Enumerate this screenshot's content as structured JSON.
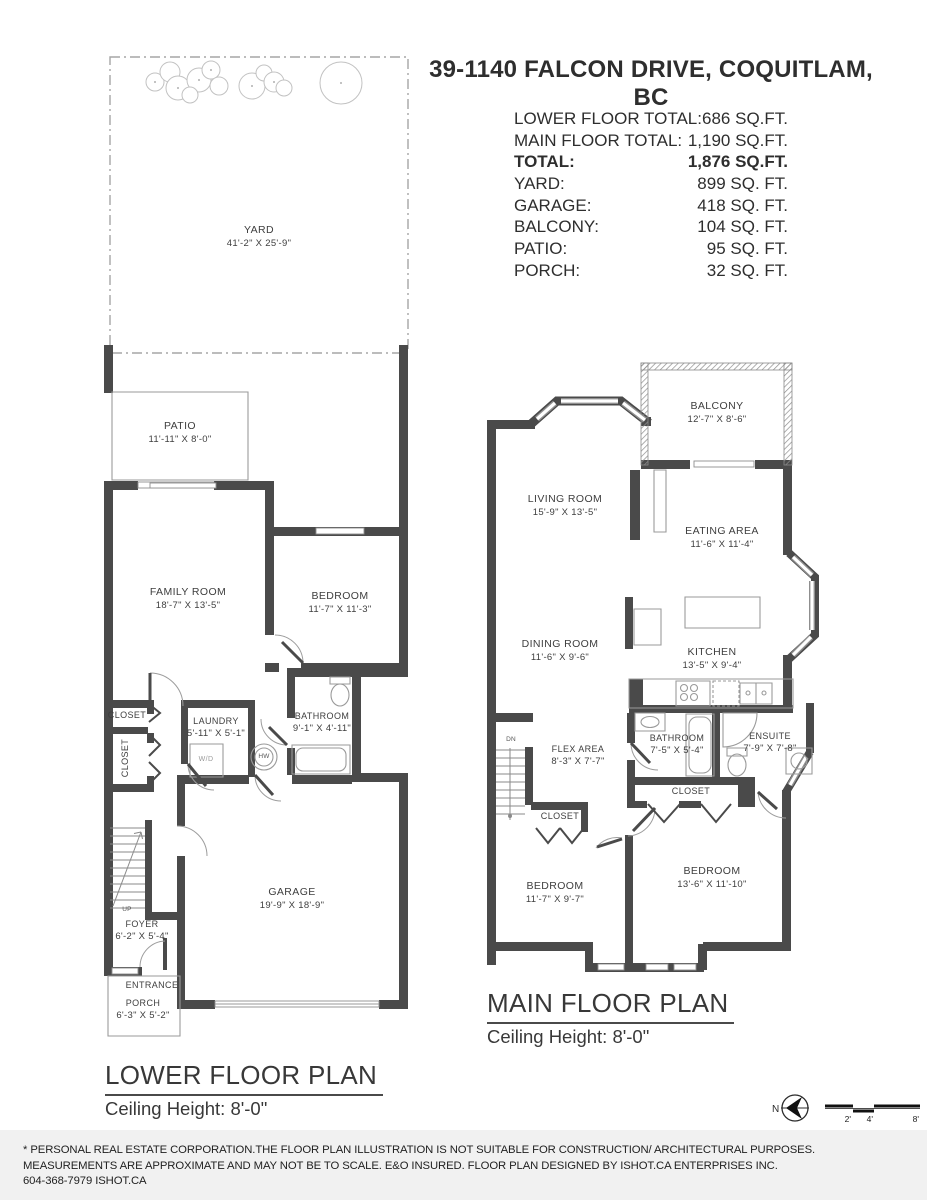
{
  "header": {
    "title": "39-1140 FALCON DRIVE, COQUITLAM, BC",
    "stats": [
      {
        "label": "LOWER FLOOR TOTAL:",
        "value": "686 SQ.FT."
      },
      {
        "label": "MAIN FLOOR TOTAL:",
        "value": "1,190 SQ.FT."
      },
      {
        "label": "TOTAL:",
        "value": "1,876 SQ.FT."
      },
      {
        "label": "YARD:",
        "value": "899 SQ. FT."
      },
      {
        "label": "GARAGE:",
        "value": "418 SQ. FT."
      },
      {
        "label": "BALCONY:",
        "value": "104 SQ. FT."
      },
      {
        "label": "PATIO:",
        "value": "95 SQ. FT."
      },
      {
        "label": "PORCH:",
        "value": "32 SQ. FT."
      }
    ]
  },
  "lower_plan": {
    "title": "LOWER FLOOR PLAN",
    "ceiling": "Ceiling Height: 8'-0\"",
    "rooms": [
      {
        "name": "YARD",
        "dims": "41'-2\" X 25'-9\""
      },
      {
        "name": "PATIO",
        "dims": "11'-11\" X 8'-0\""
      },
      {
        "name": "FAMILY ROOM",
        "dims": "18'-7\" X 13'-5\""
      },
      {
        "name": "BEDROOM",
        "dims": "11'-7\" X 11'-3\""
      },
      {
        "name": "CLOSET",
        "dims": ""
      },
      {
        "name": "CLOSET",
        "dims": ""
      },
      {
        "name": "LAUNDRY",
        "dims": "5'-11\" X 5'-1\""
      },
      {
        "name": "BATHROOM",
        "dims": "9'-1\" X 4'-11\""
      },
      {
        "name": "GARAGE",
        "dims": "19'-9\" X 18'-9\""
      },
      {
        "name": "FOYER",
        "dims": "6'-2\" X 5'-4\""
      },
      {
        "name": "ENTRANCE",
        "dims": ""
      },
      {
        "name": "PORCH",
        "dims": "6'-3\" X 5'-2\""
      }
    ],
    "markers": {
      "up": "UP",
      "wd": "W/D",
      "hw": "HW"
    }
  },
  "main_plan": {
    "title": "MAIN FLOOR PLAN",
    "ceiling": "Ceiling Height: 8'-0\"",
    "rooms": [
      {
        "name": "BALCONY",
        "dims": "12'-7\" X 8'-6\""
      },
      {
        "name": "LIVING ROOM",
        "dims": "15'-9\" X 13'-5\""
      },
      {
        "name": "EATING AREA",
        "dims": "11'-6\" X 11'-4\""
      },
      {
        "name": "DINING ROOM",
        "dims": "11'-6\" X 9'-6\""
      },
      {
        "name": "KITCHEN",
        "dims": "13'-5\" X 9'-4\""
      },
      {
        "name": "FLEX AREA",
        "dims": "8'-3\" X 7'-7\""
      },
      {
        "name": "BATHROOM",
        "dims": "7'-5\" X 5'-4\""
      },
      {
        "name": "ENSUITE",
        "dims": "7'-9\" X 7'-8\""
      },
      {
        "name": "CLOSET",
        "dims": ""
      },
      {
        "name": "CLOSET",
        "dims": ""
      },
      {
        "name": "BEDROOM",
        "dims": "11'-7\" X 9'-7\""
      },
      {
        "name": "BEDROOM",
        "dims": "13'-6\" X 11'-10\""
      }
    ],
    "markers": {
      "dn": "DN"
    }
  },
  "footer": {
    "line1": "* PERSONAL REAL ESTATE CORPORATION.THE FLOOR PLAN ILLUSTRATION IS NOT SUITABLE FOR CONSTRUCTION/ ARCHITECTURAL PURPOSES.",
    "line2": "MEASUREMENTS ARE APPROXIMATE AND MAY NOT BE TO SCALE. E&O INSURED. FLOOR PLAN DESIGNED BY ISHOT.CA ENTERPRISES INC.",
    "line3": "604-368-7979  ISHOT.CA",
    "compass_n": "N",
    "scale_ticks": {
      "t2": "2'",
      "t4": "4'",
      "t8": "8'"
    },
    "logo_left": "ISH",
    "logo_right": "T"
  },
  "colors": {
    "wall": "#4a4a4a",
    "outline": "#9a9a9a",
    "footer_bg": "#f1f1f1",
    "text": "#3e3e3e"
  }
}
